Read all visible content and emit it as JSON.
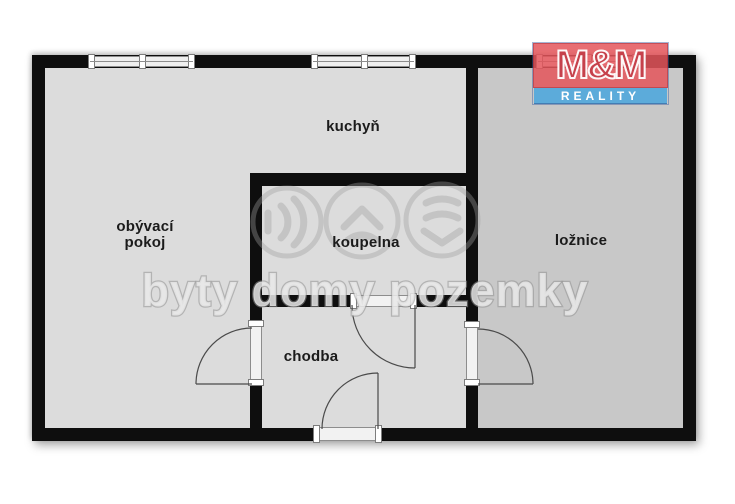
{
  "rooms": {
    "living_room": "obývací pokoj",
    "kitchen": "kuchyň",
    "bathroom": "koupelna",
    "bedroom": "ložnice",
    "hallway": "chodba"
  },
  "watermark": {
    "text": "byty domy pozemky"
  },
  "logo": {
    "line1": "M&M",
    "line2": "REALITY",
    "red": "#e4555a",
    "blue": "#54a9db"
  },
  "colors": {
    "wall": "#0e0e0e",
    "floor": "#dcdcdc",
    "bedroom_floor": "#c8c8c8",
    "label_text": "#1b1b1b",
    "watermark_gray": "#9e9e9e"
  }
}
